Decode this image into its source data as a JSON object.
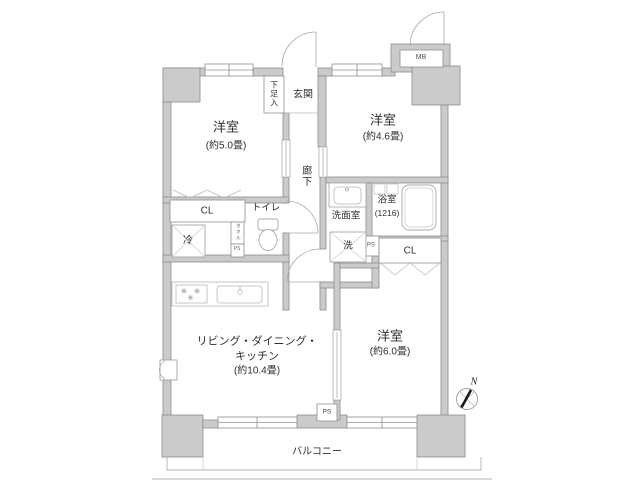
{
  "plan": {
    "rooms": {
      "bedroom1": {
        "name": "洋室",
        "size": "(約5.0畳)"
      },
      "bedroom2": {
        "name": "洋室",
        "size": "(約4.6畳)"
      },
      "bedroom3": {
        "name": "洋室",
        "size": "(約6.0畳)"
      },
      "ldk": {
        "line1": "リビング・ダイニング・",
        "line2": "キッチン",
        "size": "(約10.4畳)"
      },
      "entrance": {
        "label": "玄関"
      },
      "shoe_cabinet": {
        "label": "下足入"
      },
      "hallway": {
        "label": "廊下"
      },
      "toilet": {
        "label": "トイレ"
      },
      "washroom": {
        "label": "洗面室"
      },
      "bathroom": {
        "name": "浴室",
        "size": "(1216)"
      }
    },
    "fixtures": {
      "washer": "洗",
      "fridge": "冷"
    },
    "labels": {
      "cl": "CL",
      "ps": "PS",
      "mb": "MB",
      "towel": "タオル",
      "balcony": "バルコニー",
      "north": "N"
    },
    "colors": {
      "wall_fill": "#cbcbcb",
      "wall_stroke": "#8b8b8b",
      "fixture_line": "#b3b3b3",
      "text": "#2e2e2e",
      "needle": "#1a1a1a"
    }
  }
}
